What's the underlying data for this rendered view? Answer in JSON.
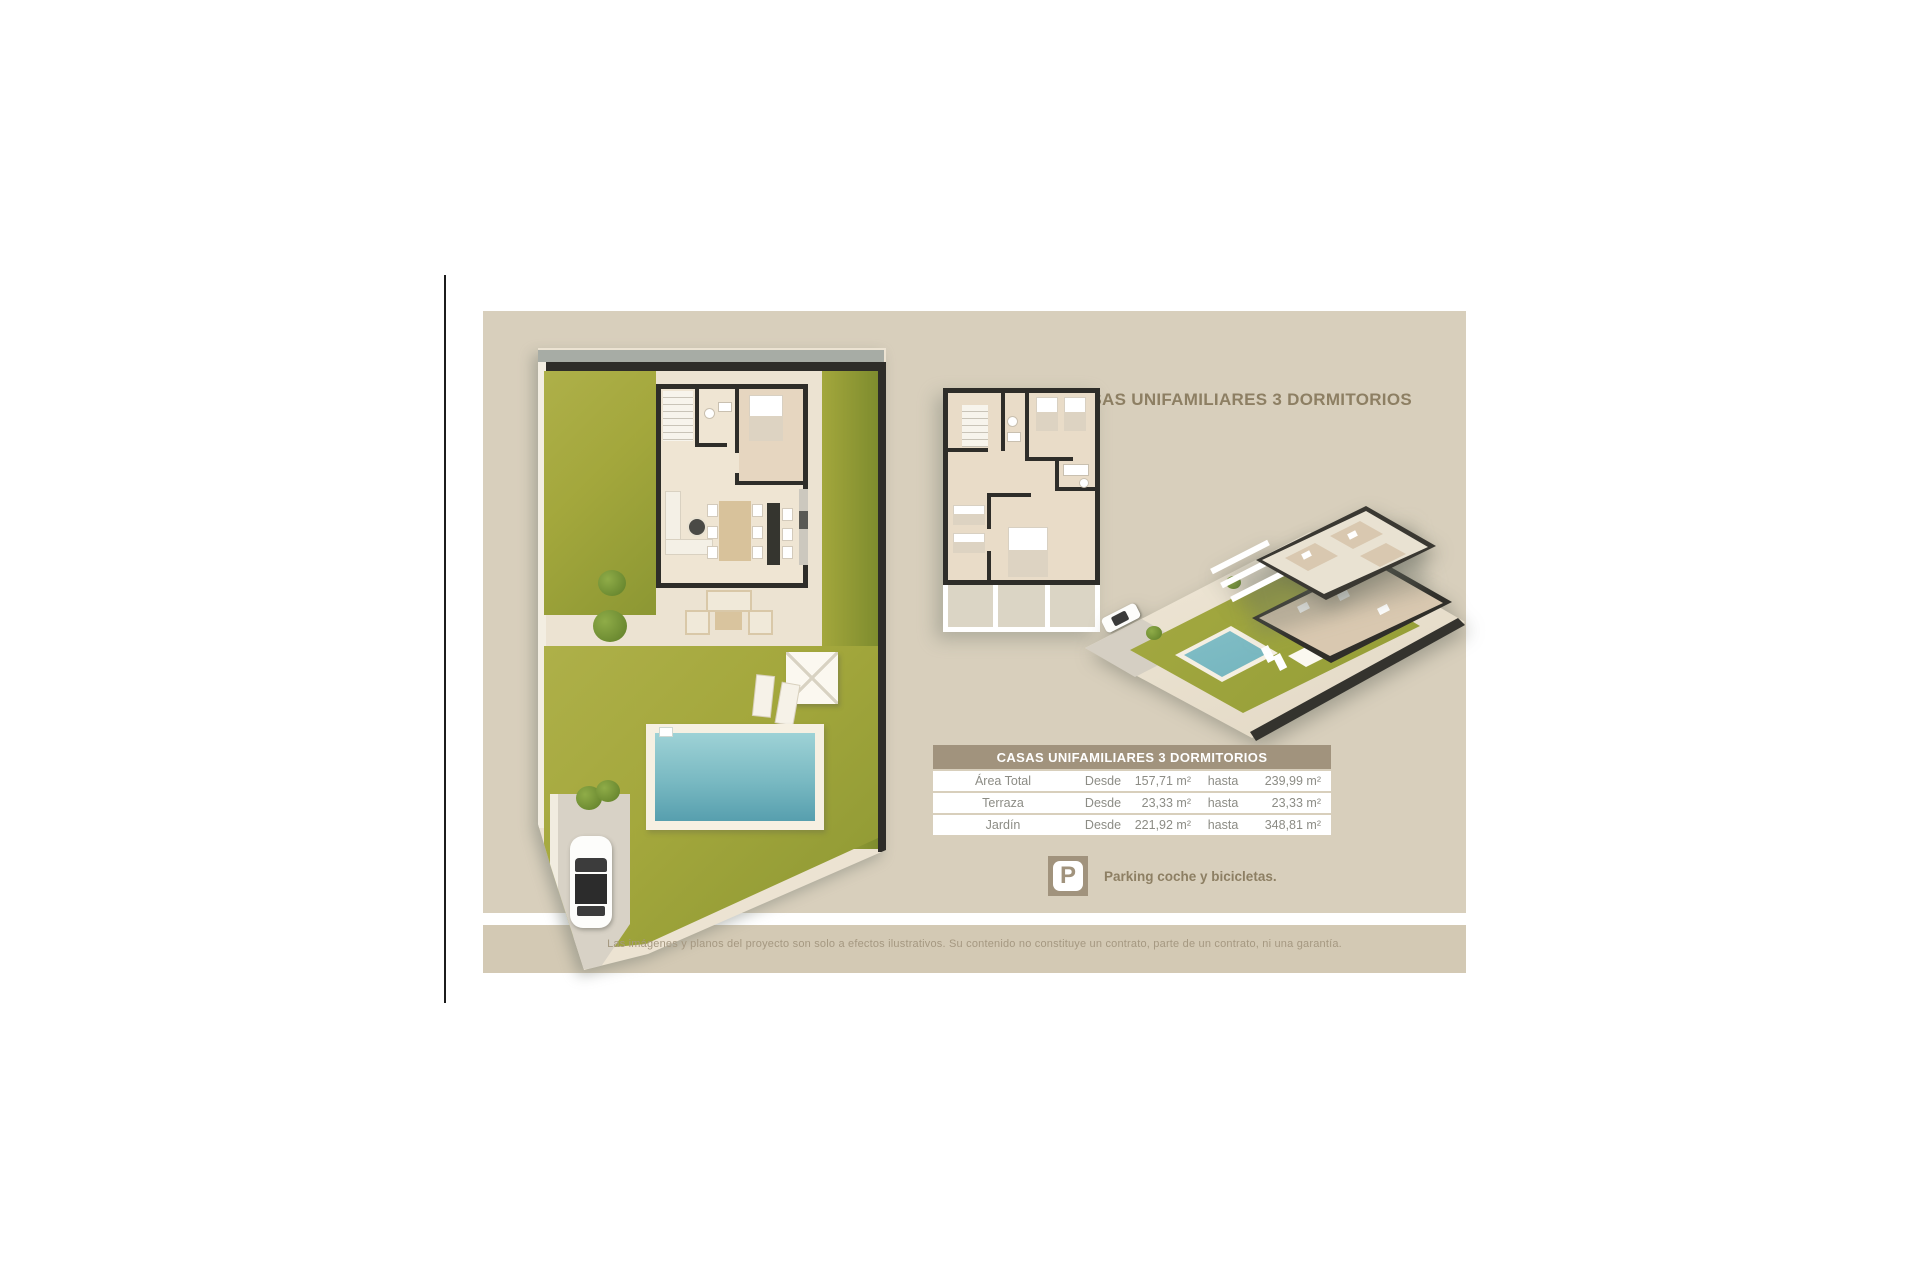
{
  "title": "CASAS UNIFAMILIARES 3 DORMITORIOS",
  "table": {
    "header": "CASAS UNIFAMILIARES 3 DORMITORIOS",
    "rows": [
      {
        "label": "Área Total",
        "from_label": "Desde",
        "from_value": "157,71 m²",
        "to_label": "hasta",
        "to_value": "239,99 m²"
      },
      {
        "label": "Terraza",
        "from_label": "Desde",
        "from_value": "23,33 m²",
        "to_label": "hasta",
        "to_value": "23,33 m²"
      },
      {
        "label": "Jardín",
        "from_label": "Desde",
        "from_value": "221,92 m²",
        "to_label": "hasta",
        "to_value": "348,81 m²"
      }
    ]
  },
  "parking": {
    "icon": "parking-icon",
    "icon_letter": "P",
    "label": "Parking coche y bicicletas."
  },
  "disclaimer": "Las imágenes y planos del proyecto son solo a efectos ilustrativos. Su contenido no constituye un contrato, parte de un contrato, ni una garantía.",
  "illustrations": {
    "ground_floor_plan": "planta baja con jardín y piscina",
    "upper_floor_plan": "planta alta 3 dormitorios",
    "iso_view": "vista isométrica 3D de la parcela"
  },
  "colors": {
    "card": "#d8cfbc",
    "footer": "#d3c9b4",
    "table_header": "#a1937d",
    "title_text": "#8d7f63",
    "lawn": "#a3a73c",
    "pool_water": "#79b9c2",
    "wall": "#2e2d29",
    "row_text": "#8c8c85",
    "disclaimer_text": "#a59881"
  }
}
